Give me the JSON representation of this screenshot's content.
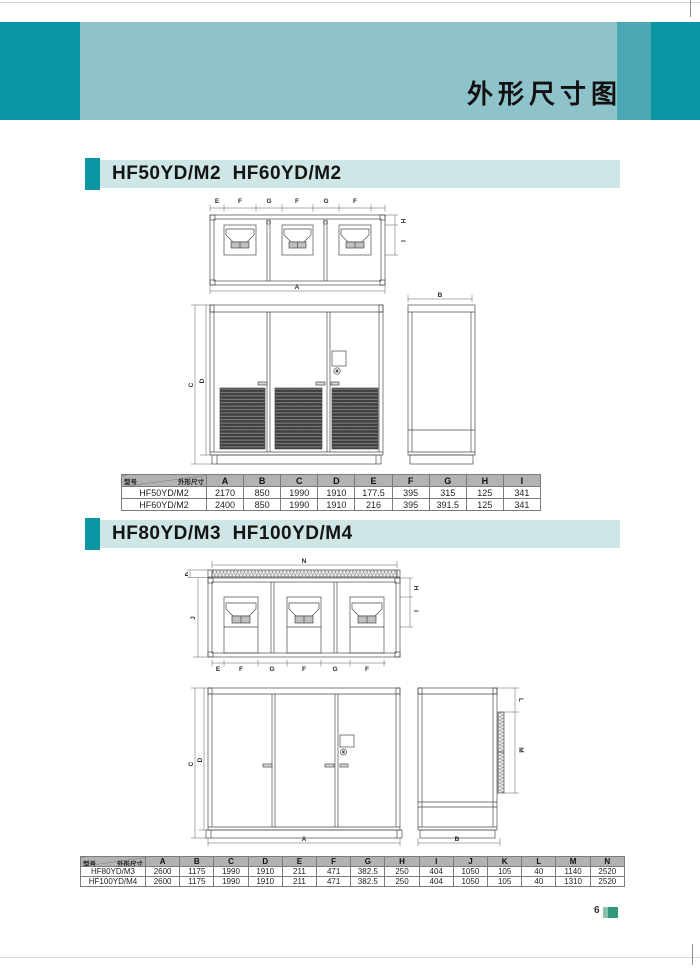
{
  "page": {
    "title": "外形尺寸图",
    "page_number": "6"
  },
  "colors": {
    "teal_dark": "#0b96a4",
    "teal_light": "#8fc3cb",
    "teal_mid": "#4aa7b3",
    "bar_bg": "#cfe6e7",
    "table_header_bg": "#b2b2b2",
    "badge_green": "#33977d",
    "badge_green_light": "#8cc3aa"
  },
  "section1": {
    "heading": "HF50YD/M2  HF60YD/M2",
    "dims": {
      "top": [
        "E",
        "F",
        "G",
        "F",
        "G",
        "F"
      ],
      "right": [
        "H",
        "I"
      ],
      "bottom": "A",
      "side_top": "B",
      "front_left": [
        "C",
        "D"
      ]
    },
    "table": {
      "corner_row_label": "型号",
      "corner_col_label": "外形尺寸",
      "columns": [
        "A",
        "B",
        "C",
        "D",
        "E",
        "F",
        "G",
        "H",
        "I"
      ],
      "rows": [
        {
          "model": "HF50YD/M2",
          "values": [
            "2170",
            "850",
            "1990",
            "1910",
            "177.5",
            "395",
            "315",
            "125",
            "341"
          ]
        },
        {
          "model": "HF60YD/M2",
          "values": [
            "2400",
            "850",
            "1990",
            "1910",
            "216",
            "395",
            "391.5",
            "125",
            "341"
          ]
        }
      ]
    }
  },
  "section2": {
    "heading": "HF80YD/M3  HF100YD/M4",
    "dims": {
      "top": "N",
      "left": [
        "K",
        "J"
      ],
      "right": [
        "H",
        "I"
      ],
      "bottom": [
        "E",
        "F",
        "G",
        "F",
        "G",
        "F"
      ],
      "front_left": [
        "C",
        "D"
      ],
      "front_bottom": "A",
      "side_bottom": "B",
      "side_right": [
        "L",
        "M"
      ]
    },
    "table": {
      "corner_row_label": "型号",
      "corner_col_label": "外形尺寸",
      "columns": [
        "A",
        "B",
        "C",
        "D",
        "E",
        "F",
        "G",
        "H",
        "I",
        "J",
        "K",
        "L",
        "M",
        "N"
      ],
      "rows": [
        {
          "model": "HF80YD/M3",
          "values": [
            "2600",
            "1175",
            "1990",
            "1910",
            "211",
            "471",
            "382.5",
            "250",
            "404",
            "1050",
            "105",
            "40",
            "1140",
            "2520"
          ]
        },
        {
          "model": "HF100YD/M4",
          "values": [
            "2600",
            "1175",
            "1990",
            "1910",
            "211",
            "471",
            "382.5",
            "250",
            "404",
            "1050",
            "105",
            "40",
            "1310",
            "2520"
          ]
        }
      ]
    }
  }
}
